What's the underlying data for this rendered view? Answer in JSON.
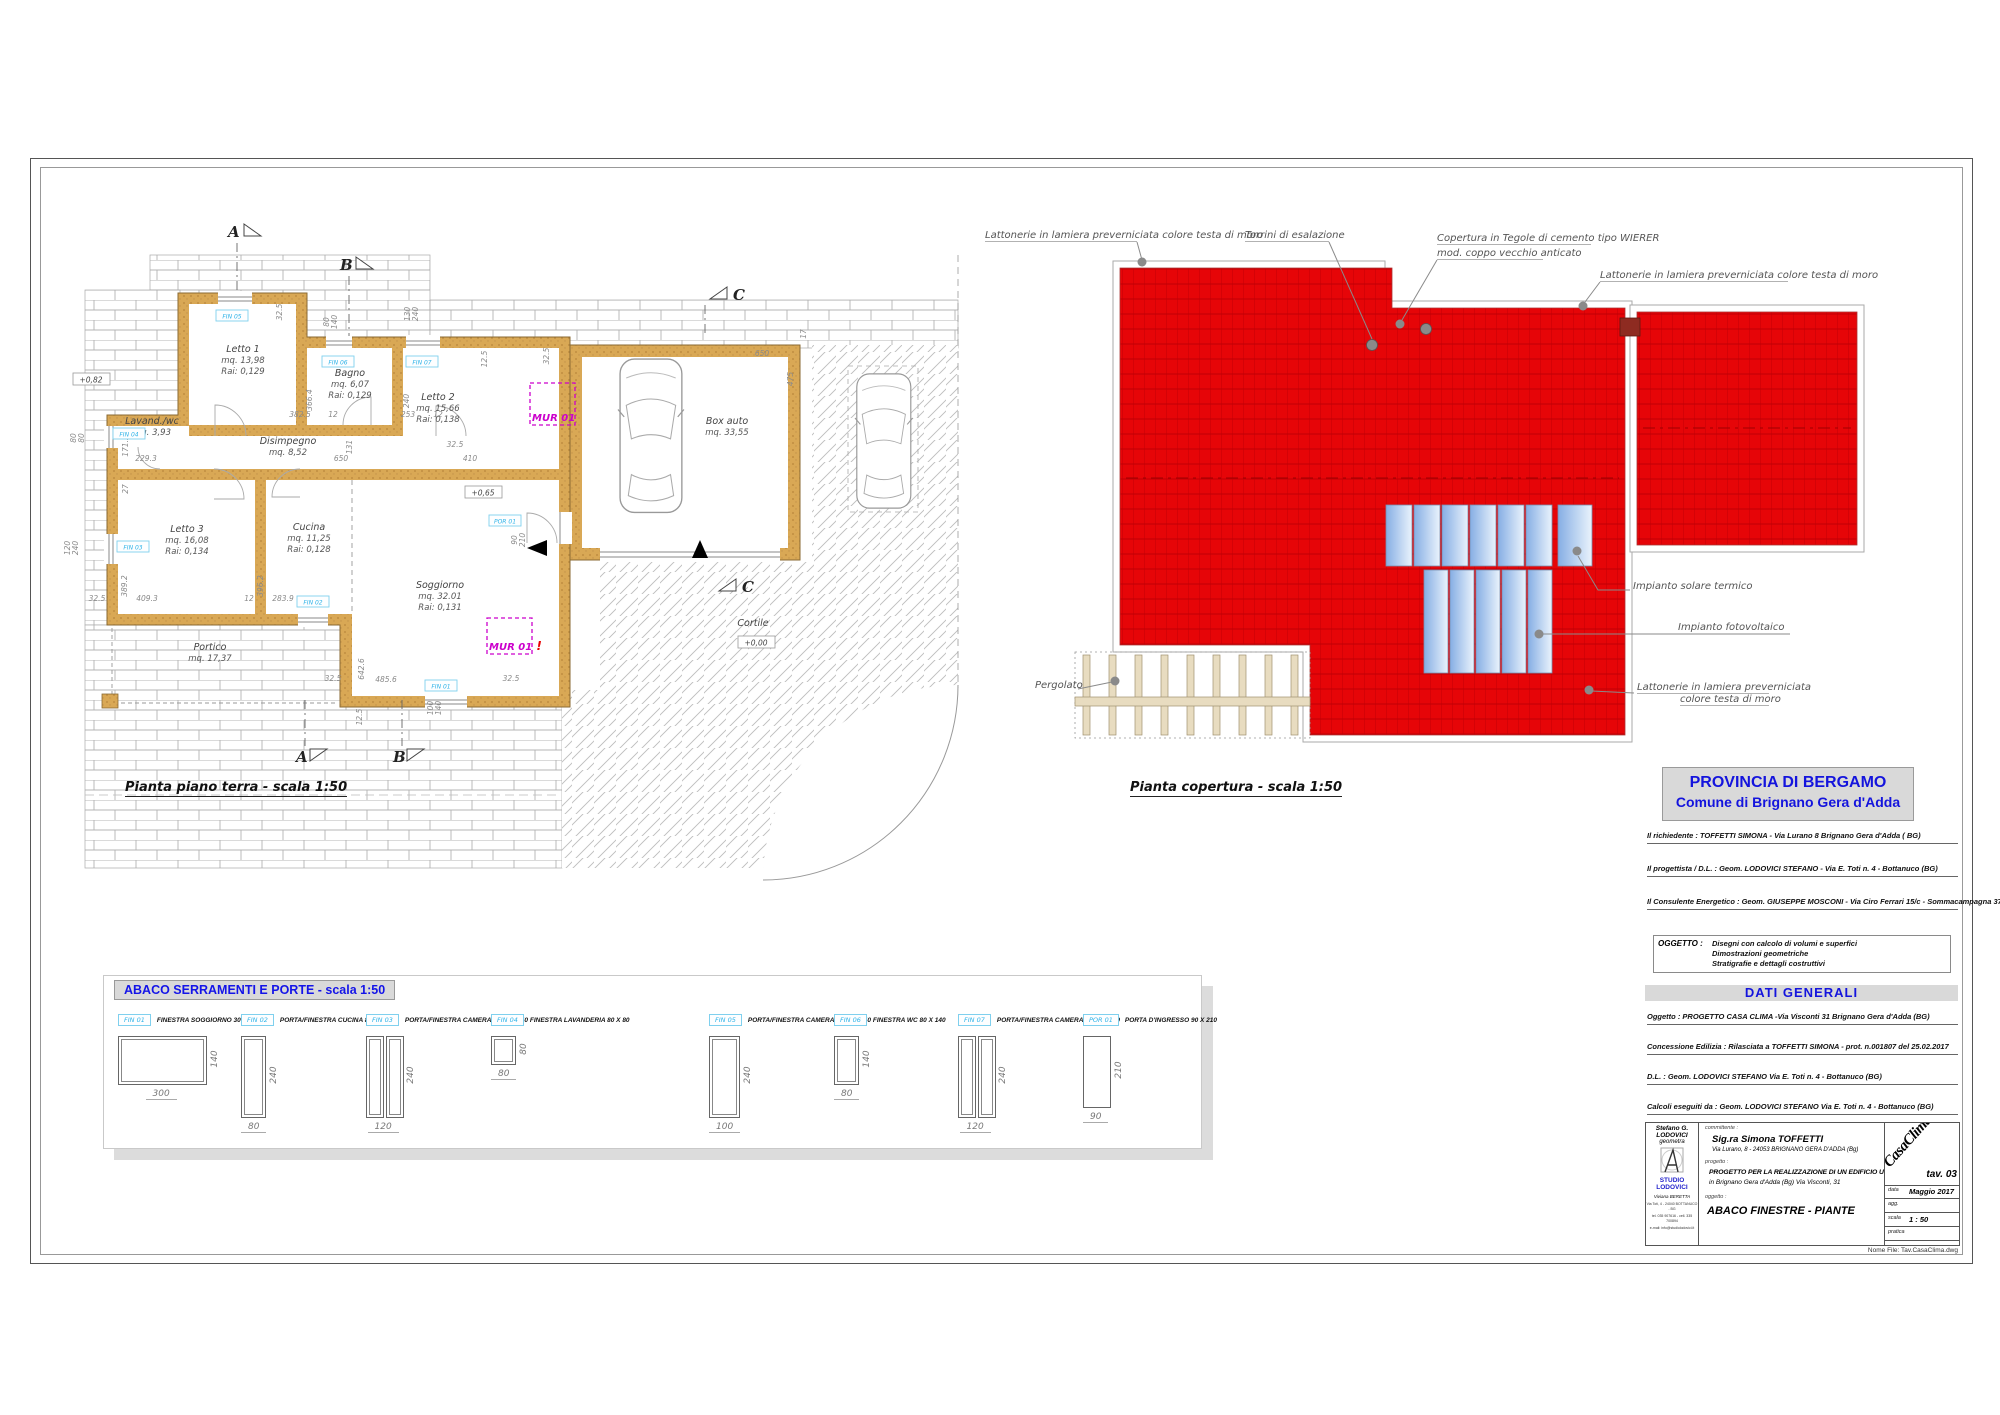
{
  "sheet": {
    "floor_plan_title": "Pianta piano terra - scala 1:50",
    "roof_plan_title": "Pianta copertura - scala 1:50"
  },
  "floor_plan": {
    "rooms": [
      {
        "name": "Letto 1",
        "l2": "mq. 13,98",
        "l3": "Rai: 0,129",
        "x": 243,
        "y": 352
      },
      {
        "name": "Bagno",
        "l2": "mq. 6,07",
        "l3": "Rai: 0,129",
        "x": 350,
        "y": 376
      },
      {
        "name": "Letto 2",
        "l2": "mq. 15,66",
        "l3": "Rai: 0,138",
        "x": 438,
        "y": 400
      },
      {
        "name": "Lavand./wc",
        "l2": "mq. 3,93",
        "l3": "",
        "x": 152,
        "y": 424
      },
      {
        "name": "Disimpegno",
        "l2": "mq. 8,52",
        "l3": "",
        "x": 288,
        "y": 444
      },
      {
        "name": "Letto 3",
        "l2": "mq. 16,08",
        "l3": "Rai: 0,134",
        "x": 187,
        "y": 532
      },
      {
        "name": "Cucina",
        "l2": "mq. 11,25",
        "l3": "Rai: 0,128",
        "x": 309,
        "y": 530
      },
      {
        "name": "Soggiorno",
        "l2": "mq. 32.01",
        "l3": "Rai: 0,131",
        "x": 440,
        "y": 588
      },
      {
        "name": "Portico",
        "l2": "mq. 17,37",
        "l3": "",
        "x": 210,
        "y": 650
      },
      {
        "name": "Box auto",
        "l2": "mq. 33,55",
        "l3": "",
        "x": 727,
        "y": 424
      },
      {
        "name": "Cortile",
        "l2": "",
        "l3": "",
        "x": 753,
        "y": 626
      }
    ],
    "levels": [
      {
        "t": "+0,82",
        "x": 91,
        "y": 382
      },
      {
        "t": "+0,65",
        "x": 483,
        "y": 495
      },
      {
        "t": "+0,00",
        "x": 756,
        "y": 645
      }
    ],
    "mur": [
      {
        "t": "MUR 01",
        "bx": 530,
        "by": 383,
        "bw": 45,
        "bh": 42,
        "excl": false
      },
      {
        "t": "MUR 01",
        "bx": 487,
        "by": 618,
        "bw": 45,
        "bh": 36,
        "excl": true
      }
    ],
    "tags": [
      {
        "t": "FIN 05",
        "x": 232,
        "y": 316
      },
      {
        "t": "FIN 06",
        "x": 338,
        "y": 362
      },
      {
        "t": "FIN 07",
        "x": 422,
        "y": 362
      },
      {
        "t": "FIN 04",
        "x": 129,
        "y": 434
      },
      {
        "t": "FIN 03",
        "x": 133,
        "y": 547
      },
      {
        "t": "FIN 02",
        "x": 313,
        "y": 602
      },
      {
        "t": "FIN 01",
        "x": 441,
        "y": 686
      },
      {
        "t": "POR 01",
        "x": 505,
        "y": 521
      }
    ],
    "sections": [
      {
        "t": "A",
        "x": 228,
        "y": 237,
        "tri": "r"
      },
      {
        "t": "B",
        "x": 340,
        "y": 270,
        "tri": "r"
      },
      {
        "t": "C",
        "x": 733,
        "y": 300,
        "tri": "l"
      },
      {
        "t": "A",
        "x": 296,
        "y": 762,
        "tri": "d"
      },
      {
        "t": "B",
        "x": 393,
        "y": 762,
        "tri": "d"
      },
      {
        "t": "C",
        "x": 742,
        "y": 592,
        "tri": "l"
      }
    ],
    "dims": [
      {
        "t": "382.5",
        "x": 300,
        "y": 417
      },
      {
        "t": "12",
        "x": 333,
        "y": 417
      },
      {
        "t": "366.4",
        "x": 312,
        "y": 400,
        "r": -90
      },
      {
        "t": "253",
        "x": 408,
        "y": 417
      },
      {
        "t": "12",
        "x": 438,
        "y": 417
      },
      {
        "t": "240",
        "x": 409,
        "y": 401,
        "r": -90
      },
      {
        "t": "650",
        "x": 341,
        "y": 461
      },
      {
        "t": "131",
        "x": 352,
        "y": 447,
        "r": -90
      },
      {
        "t": "410",
        "x": 470,
        "y": 461
      },
      {
        "t": "32.5",
        "x": 455,
        "y": 447
      },
      {
        "t": "229.3",
        "x": 146,
        "y": 461
      },
      {
        "t": "171.2",
        "x": 128,
        "y": 446,
        "r": -90
      },
      {
        "t": "27",
        "x": 128,
        "y": 489,
        "r": -90
      },
      {
        "t": "80",
        "x": 76,
        "y": 438,
        "r": -90
      },
      {
        "t": "80",
        "x": 84,
        "y": 438,
        "r": -90
      },
      {
        "t": "120",
        "x": 70,
        "y": 548,
        "r": -90
      },
      {
        "t": "240",
        "x": 78,
        "y": 548,
        "r": -90
      },
      {
        "t": "409.3",
        "x": 147,
        "y": 601
      },
      {
        "t": "389.2",
        "x": 127,
        "y": 586,
        "r": -90
      },
      {
        "t": "12",
        "x": 249,
        "y": 601
      },
      {
        "t": "283.9",
        "x": 283,
        "y": 601
      },
      {
        "t": "396.2",
        "x": 263,
        "y": 586,
        "r": -90
      },
      {
        "t": "32.5",
        "x": 97,
        "y": 601
      },
      {
        "t": "32.5",
        "x": 333,
        "y": 681
      },
      {
        "t": "32.5",
        "x": 511,
        "y": 681
      },
      {
        "t": "642.6",
        "x": 364,
        "y": 669,
        "r": -90
      },
      {
        "t": "485.6",
        "x": 386,
        "y": 682
      },
      {
        "t": "12.5",
        "x": 362,
        "y": 717,
        "r": -90
      },
      {
        "t": "100",
        "x": 433,
        "y": 708,
        "r": -90
      },
      {
        "t": "140",
        "x": 441,
        "y": 708,
        "r": -90
      },
      {
        "t": "32.5",
        "x": 282,
        "y": 312,
        "r": -90
      },
      {
        "t": "130",
        "x": 410,
        "y": 314,
        "r": -90
      },
      {
        "t": "240",
        "x": 418,
        "y": 314,
        "r": -90
      },
      {
        "t": "80",
        "x": 329,
        "y": 322,
        "r": -90
      },
      {
        "t": "140",
        "x": 337,
        "y": 322,
        "r": -90
      },
      {
        "t": "12.5",
        "x": 487,
        "y": 359,
        "r": -90
      },
      {
        "t": "650",
        "x": 762,
        "y": 356
      },
      {
        "t": "475",
        "x": 793,
        "y": 379,
        "r": -90
      },
      {
        "t": "17",
        "x": 806,
        "y": 334,
        "r": -90
      },
      {
        "t": "32.5",
        "x": 549,
        "y": 356,
        "r": -90
      },
      {
        "t": "90",
        "x": 517,
        "y": 540,
        "r": -90
      },
      {
        "t": "210",
        "x": 525,
        "y": 540,
        "r": -90
      }
    ]
  },
  "roof_plan": {
    "annotations": [
      {
        "t": "Lattonerie in lamiera preverniciata colore testa di moro",
        "x": 985,
        "y": 238,
        "u": 152
      },
      {
        "t": "Torrini di esalazione",
        "x": 1245,
        "y": 238,
        "u": 84
      },
      {
        "t": "Copertura in Tegole di cemento tipo WIERER",
        "x": 1437,
        "y": 241,
        "u": 154
      },
      {
        "t": "mod. coppo vecchio anticato",
        "x": 1437,
        "y": 256,
        "u": 106
      },
      {
        "t": "Lattonerie in lamiera preverniciata colore testa di moro",
        "x": 1600,
        "y": 278,
        "u": 188
      },
      {
        "t": "Impianto solare termico",
        "x": 1633,
        "y": 589,
        "u": 0
      },
      {
        "t": "Impianto fotovoltaico",
        "x": 1678,
        "y": 630,
        "u": 0
      },
      {
        "t": "Lattonerie in lamiera preverniciata",
        "x": 1637,
        "y": 690,
        "u": 132
      },
      {
        "t": "colore testa di moro",
        "x": 1680,
        "y": 702,
        "u": 89
      },
      {
        "t": "Pergolato",
        "x": 1035,
        "y": 688,
        "u": 0
      }
    ]
  },
  "abaco": {
    "title": "ABACO SERRAMENTI E PORTE - scala 1:50",
    "items": [
      {
        "tag": "FIN 01",
        "label": "FINESTRA SOGGIORNO 300 X 140",
        "w": 300,
        "h": 140,
        "type": "single"
      },
      {
        "tag": "FIN 02",
        "label": "PORTA/FINESTRA CUCINA 80 X 240",
        "w": 80,
        "h": 240,
        "type": "single"
      },
      {
        "tag": "FIN 03",
        "label": "PORTA/FINESTRA CAMERA 3 120 X 240",
        "w": 120,
        "h": 240,
        "type": "double"
      },
      {
        "tag": "FIN 04",
        "label": "FINESTRA LAVANDERIA  80 X 80",
        "w": 80,
        "h": 80,
        "type": "single"
      },
      {
        "tag": "FIN 05",
        "label": "PORTA/FINESTRA CAMERA 1 100 X 240",
        "w": 100,
        "h": 240,
        "type": "single"
      },
      {
        "tag": "FIN 06",
        "label": "FINESTRA WC 80 X 140",
        "w": 80,
        "h": 140,
        "type": "single"
      },
      {
        "tag": "FIN 07",
        "label": "PORTA/FINESTRA CAMERA 2 120 X 240",
        "w": 120,
        "h": 240,
        "type": "double"
      },
      {
        "tag": "POR 01",
        "label": "PORTA D'INGRESSO 90 X 210",
        "w": 90,
        "h": 210,
        "type": "door"
      }
    ]
  },
  "title_block": {
    "header_line1": "PROVINCIA DI BERGAMO",
    "header_line2": "Comune di Brignano Gera d'Adda",
    "parties": [
      "Il richiedente : TOFFETTI SIMONA - Via Lurano 8 Brignano Gera d'Adda ( BG)",
      "Il progettista / D.L. : Geom. LODOVICI STEFANO  - Via E. Toti n. 4 - Bottanuco (BG)",
      "Il Consulente Energetico : Geom. GIUSEPPE MOSCONI - Via Ciro Ferrari 15/c - Sommacampagna  37066 - (VR)"
    ],
    "oggetto_label": "OGGETTO :",
    "oggetto_lines": [
      "Disegni con calcolo di volumi e superfici",
      "Dimostrazioni geometriche",
      "Stratigrafie e dettagli costruttivi"
    ],
    "dati_generali": "DATI GENERALI",
    "dati_lines": [
      "Oggetto : PROGETTO CASA CLIMA -Via Visconti 31 Brignano Gera d'Adda  (BG)",
      "Concessione Edilizia : Rilasciata a TOFFETTI SIMONA  -  prot. n.001807  del 25.02.2017",
      "D.L. : Geom. LODOVICI STEFANO Via E. Toti n. 4 - Bottanuco (BG)",
      "Calcoli eseguiti da : Geom. LODOVICI STEFANO Via E. Toti n. 4 - Bottanuco (BG)"
    ],
    "studio": {
      "name_line1": "Stefano G. LODOVICI",
      "name_line2": "geometra",
      "studio_name": "STUDIO LODOVICI",
      "collab": "Viviana BERETTA",
      "contact1": "Via Toti, 4 - 24040 BOTTANUCO - BG",
      "contact2": "tel. 035 907616 - cell. 335 700894",
      "contact3": "e-mail: info@studiolodovici.it"
    },
    "committente_label": "committente :",
    "committente_name": "Sig.ra Simona TOFFETTI",
    "committente_addr": "Via Lurano, 8 - 24053 BRIGNANO GERA D'ADDA (Bg)",
    "progetto_label": "progetto :",
    "progetto_line1": "PROGETTO PER LA REALIZZAZIONE DI UN EDIFICIO UNIFAMILIARE",
    "progetto_line2": "in Brignano Gera d'Adda (Bg) Via Visconti, 31",
    "oggetto2_label": "oggetto :",
    "oggetto2": "ABACO FINESTRE - PIANTE",
    "logo_text": "CasaClima",
    "tav": "tav. 03",
    "rows": [
      {
        "k": "data",
        "v": "Maggio 2017"
      },
      {
        "k": "agg.",
        "v": ""
      },
      {
        "k": "scala",
        "v": "1 : 50"
      },
      {
        "k": "pratica",
        "v": ""
      }
    ],
    "file_label": "Nome  File:  Tav.CasaClima.dwg"
  }
}
